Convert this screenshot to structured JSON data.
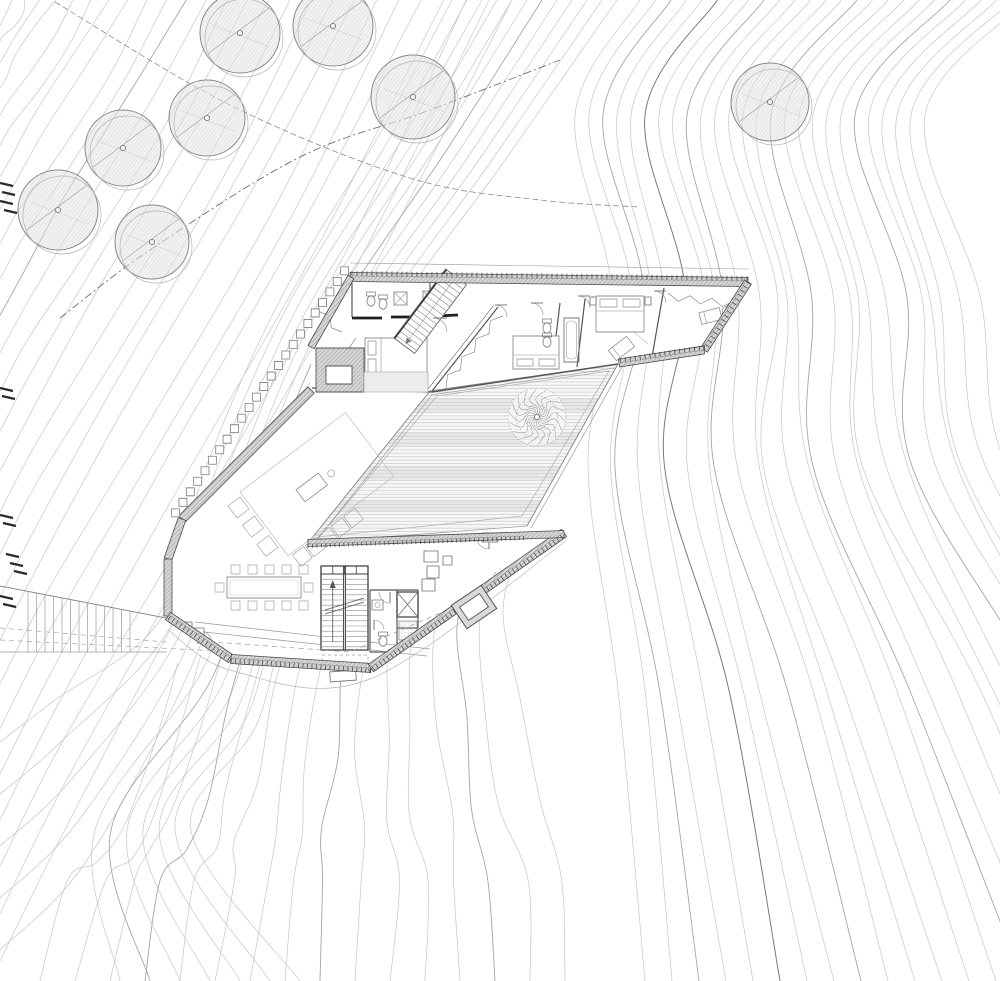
{
  "document": {
    "type": "architectural-site-plan",
    "canvas_width": 1000,
    "canvas_height": 981,
    "background": "#ffffff"
  },
  "palette": {
    "contour": "#c6c6c6",
    "contour_index": "#a6a6a6",
    "contour_dark": "#7a7a7a",
    "wall_edge": "#4a4a4a",
    "wall_fill": "#d6d6d6",
    "wall_hatch": "#9b9b9b",
    "furniture": "#8f8f8f",
    "thin_gray": "#9a9a9a",
    "deck_line": "#c2c2c2",
    "deck_band": "#e9e9e9",
    "tree_outline": "#898989",
    "tree_hatch": "#c2c2c2",
    "comb": "#3f3f3f",
    "cliff": "#2a2a2a",
    "drip": "#b8b8b8"
  },
  "contours": {
    "families": [
      {
        "name": "northwest-slope",
        "count": 26
      },
      {
        "name": "west-wrap",
        "count": 12
      },
      {
        "name": "east-slope",
        "count": 26
      },
      {
        "name": "south-fan",
        "count": 16
      }
    ],
    "boundary_lines": [
      {
        "pts": [
          [
            55,
            2
          ],
          [
            230,
            105
          ],
          [
            410,
            178
          ],
          [
            540,
            200
          ],
          [
            640,
            207
          ]
        ],
        "dash": "6,3",
        "color": "#8a8a8a",
        "w": 0.8
      },
      {
        "pts": [
          [
            60,
            318
          ],
          [
            150,
            250
          ],
          [
            300,
            157
          ],
          [
            430,
            110
          ],
          [
            560,
            60
          ]
        ],
        "dash": "8,3,2,3",
        "color": "#6f6f6f",
        "w": 0.9
      }
    ],
    "cliff_marks": [
      {
        "x": 0,
        "y": 183
      },
      {
        "x": 2,
        "y": 192
      },
      {
        "x": 0,
        "y": 201
      },
      {
        "x": 4,
        "y": 210
      },
      {
        "x": 0,
        "y": 388
      },
      {
        "x": 2,
        "y": 396
      },
      {
        "x": 0,
        "y": 515
      },
      {
        "x": 3,
        "y": 523
      },
      {
        "x": 6,
        "y": 554
      },
      {
        "x": 10,
        "y": 563
      },
      {
        "x": 14,
        "y": 571
      },
      {
        "x": 0,
        "y": 596
      },
      {
        "x": 3,
        "y": 604
      }
    ]
  },
  "site": {
    "trees": [
      {
        "x": 240,
        "y": 33,
        "r": 40
      },
      {
        "x": 333,
        "y": 26,
        "r": 40
      },
      {
        "x": 413,
        "y": 97,
        "r": 42
      },
      {
        "x": 207,
        "y": 118,
        "r": 38
      },
      {
        "x": 123,
        "y": 148,
        "r": 38
      },
      {
        "x": 58,
        "y": 210,
        "r": 40
      },
      {
        "x": 152,
        "y": 242,
        "r": 37
      },
      {
        "x": 770,
        "y": 102,
        "r": 39
      }
    ],
    "courtyard_tree": {
      "x": 537,
      "y": 417,
      "r": 29
    },
    "walkway": {
      "rail_top": [
        [
          0,
          586
        ],
        [
          166,
          618
        ]
      ],
      "rail_bottom": [
        [
          0,
          652
        ],
        [
          167,
          652
        ]
      ],
      "tread_from": 28,
      "tread_to": 130,
      "tread_count": 13,
      "dashes": [
        [
          [
            0,
            628
          ],
          [
            166,
            642
          ]
        ],
        [
          [
            0,
            640
          ],
          [
            240,
            652
          ]
        ]
      ]
    }
  },
  "building": {
    "envelope": [
      [
        352,
        276
      ],
      [
        747,
        281
      ],
      [
        703,
        350
      ],
      [
        618,
        363
      ],
      [
        527,
        525
      ],
      [
        563,
        533
      ],
      [
        370,
        668
      ],
      [
        230,
        659
      ],
      [
        168,
        615
      ],
      [
        168,
        558
      ],
      [
        183,
        518
      ],
      [
        310,
        391
      ],
      [
        312,
        345
      ]
    ],
    "deck": {
      "outline": [
        [
          430,
          391
        ],
        [
          618,
          364
        ],
        [
          527,
          526
        ],
        [
          308,
          543
        ]
      ],
      "inner_outline": [
        [
          437,
          396
        ],
        [
          609,
          371
        ],
        [
          522,
          516
        ],
        [
          319,
          537
        ]
      ],
      "light_bands": [
        [
          398,
          14
        ],
        [
          432,
          14
        ],
        [
          466,
          14
        ],
        [
          500,
          12
        ]
      ]
    },
    "wall_bands": [
      {
        "p1": [
          350,
          277
        ],
        "p2": [
          748,
          282
        ],
        "w": 9
      },
      {
        "p1": [
          748,
          282
        ],
        "p2": [
          704,
          350
        ],
        "w": 8
      },
      {
        "p1": [
          704,
          350
        ],
        "p2": [
          619,
          363
        ],
        "w": 8
      },
      {
        "p1": [
          351,
          277
        ],
        "p2": [
          311,
          347
        ],
        "w": 7
      },
      {
        "p1": [
          311,
          390
        ],
        "p2": [
          182,
          519
        ],
        "w": 9
      },
      {
        "p1": [
          182,
          519
        ],
        "p2": [
          168,
          559
        ],
        "w": 8
      },
      {
        "p1": [
          168,
          559
        ],
        "p2": [
          168,
          616
        ],
        "w": 8
      },
      {
        "p1": [
          168,
          616
        ],
        "p2": [
          231,
          659
        ],
        "w": 9
      },
      {
        "p1": [
          231,
          659
        ],
        "p2": [
          371,
          668
        ],
        "w": 9
      },
      {
        "p1": [
          371,
          668
        ],
        "p2": [
          564,
          533
        ],
        "w": 9
      },
      {
        "p1": [
          308,
          543
        ],
        "p2": [
          564,
          534
        ],
        "w": 7
      }
    ],
    "combs": [
      {
        "p1": [
          352,
          271
        ],
        "p2": [
          748,
          276
        ],
        "side": 1,
        "len": 5,
        "step": 5
      },
      {
        "p1": [
          750,
          284
        ],
        "p2": [
          707,
          351
        ],
        "side": 1,
        "len": 5,
        "step": 5
      },
      {
        "p1": [
          704,
          345
        ],
        "p2": [
          620,
          358
        ],
        "side": -1,
        "len": 5,
        "step": 5
      },
      {
        "p1": [
          371,
          673
        ],
        "p2": [
          564,
          538
        ],
        "side": -1,
        "len": 5,
        "step": 4.5
      },
      {
        "p1": [
          168,
          620
        ],
        "p2": [
          231,
          663
        ],
        "side": -1,
        "len": 5,
        "step": 4.5
      },
      {
        "p1": [
          231,
          663
        ],
        "p2": [
          371,
          673
        ],
        "side": -1,
        "len": 5,
        "step": 4.5
      },
      {
        "p1": [
          308,
          548
        ],
        "p2": [
          524,
          540
        ],
        "side": -1,
        "len": 4,
        "step": 4.5
      }
    ],
    "square_chain": {
      "from": [
        352,
        276
      ],
      "to": [
        183,
        518
      ],
      "count": 24,
      "size": 8,
      "offset": 9
    },
    "fireplace": {
      "block": [
        316,
        348,
        48,
        44
      ],
      "inner": [
        326,
        366,
        26,
        18
      ],
      "side": [
        364,
        372,
        64,
        20
      ]
    },
    "interior_walls": [
      [
        430,
        281,
        430,
        317,
        1.2
      ],
      [
        352,
        283,
        352,
        317,
        1.2
      ],
      [
        312,
        388,
        432,
        392,
        1.3
      ],
      [
        432,
        392,
        618,
        364,
        1.4
      ],
      [
        498,
        307,
        432,
        391,
        1.2
      ],
      [
        494,
        305,
        428,
        389,
        0.6
      ],
      [
        560,
        303,
        552,
        369,
        1.2
      ],
      [
        585,
        299,
        577,
        367,
        1.2
      ],
      [
        664,
        288,
        652,
        357,
        1.2
      ],
      [
        370,
        590,
        418,
        590,
        1.2
      ],
      [
        370,
        590,
        370,
        652,
        1.2
      ],
      [
        397,
        590,
        397,
        652,
        1.2
      ],
      [
        370,
        652,
        397,
        652,
        1.2
      ],
      [
        418,
        590,
        418,
        628,
        1.2
      ],
      [
        397,
        628,
        418,
        628,
        1.2
      ]
    ],
    "lintels": [
      [
        352,
        318,
        382,
        318
      ],
      [
        391,
        317,
        427,
        317
      ],
      [
        436,
        316,
        458,
        315
      ]
    ],
    "deck_edges": [
      [
        618,
        364,
        527,
        526,
        0.9
      ],
      [
        622,
        367,
        531,
        528,
        0.6
      ],
      [
        430,
        391,
        618,
        364,
        0.9
      ],
      [
        431,
        395,
        615,
        368,
        0.6
      ],
      [
        308,
        543,
        430,
        391,
        0.9
      ],
      [
        312,
        546,
        432,
        395,
        0.6
      ]
    ],
    "thin_lines": [
      [
        195,
        622,
        430,
        649,
        0.7
      ],
      [
        195,
        631,
        427,
        656,
        0.7
      ],
      [
        350,
        263,
        749,
        269,
        0.6
      ],
      [
        592,
        296,
        648,
        344,
        0.5
      ]
    ],
    "drip_lines": [
      {
        "pts": [
          [
            168,
            630
          ],
          [
            233,
            671
          ],
          [
            370,
            679
          ],
          [
            566,
            541
          ]
        ]
      }
    ],
    "stair_main": {
      "x": 321,
      "y": 566,
      "w": 47,
      "h": 84,
      "divider": 344.5,
      "step": 5.2,
      "header_h": 8
    },
    "stair_upper": {
      "x": 456,
      "y": 277,
      "angle": 127,
      "len": 86,
      "width": 26,
      "step": 5.5
    },
    "elevator": {
      "x": 397,
      "y": 592,
      "w": 21,
      "h": 25
    },
    "shower_tile": {
      "x": 399,
      "y": 621,
      "w": 18,
      "h": 19
    },
    "light_well": {
      "cx": 474,
      "cy": 607,
      "w": 36,
      "h": 28,
      "rot": -34,
      "band": 6
    },
    "furniture": [
      {
        "kind": "bed",
        "x": 365,
        "y": 338,
        "w": 62,
        "h": 38,
        "pillows": "left"
      },
      {
        "kind": "bed",
        "x": 513,
        "y": 336,
        "w": 46,
        "h": 33,
        "pillows": "bottom"
      },
      {
        "kind": "bed",
        "x": 596,
        "y": 296,
        "w": 48,
        "h": 36,
        "pillows": "top"
      },
      {
        "kind": "chair-lounge",
        "x": 610,
        "y": 342,
        "w": 23,
        "h": 13,
        "rot": -38
      },
      {
        "kind": "chair-lounge",
        "x": 700,
        "y": 310,
        "w": 21,
        "h": 12,
        "rot": -15
      }
    ],
    "dining": {
      "table": [
        227,
        577,
        74,
        21
      ],
      "chair": 9,
      "top_y": 565,
      "bottom_y": 601,
      "xs": [
        231,
        248,
        265,
        282,
        299
      ],
      "end_left": [
        215,
        583
      ],
      "end_right": [
        304,
        583
      ]
    },
    "sofa_group": {
      "tx": 240,
      "ty": 492,
      "rot": -37,
      "rug": [
        0,
        0,
        132,
        80
      ],
      "sofa_y": 82,
      "sofa_n": 5,
      "chair_x": -18,
      "chair_n": 3,
      "table": [
        46,
        32,
        28,
        15
      ]
    },
    "fixtures": [
      {
        "kind": "toilet",
        "x": 371,
        "y": 301
      },
      {
        "kind": "toilet",
        "x": 383,
        "y": 304
      },
      {
        "kind": "shower-x",
        "x": 394,
        "y": 292,
        "w": 13,
        "h": 13
      },
      {
        "kind": "shower-x",
        "x": 423,
        "y": 291,
        "w": 13,
        "h": 13
      },
      {
        "kind": "toilet",
        "x": 547,
        "y": 328
      },
      {
        "kind": "toilet",
        "x": 547,
        "y": 342
      },
      {
        "kind": "tub",
        "x": 564,
        "y": 318,
        "w": 15,
        "h": 44
      },
      {
        "kind": "sink",
        "x": 372,
        "y": 600,
        "w": 11,
        "h": 10
      },
      {
        "kind": "toilet",
        "x": 383,
        "y": 641
      }
    ],
    "zigzags": [
      {
        "x1": 356,
        "y1": 338,
        "x2": 356,
        "y2": 378,
        "amp": 7
      },
      {
        "x1": 503,
        "y1": 316,
        "x2": 446,
        "y2": 388,
        "amp": 7
      },
      {
        "x1": 668,
        "y1": 293,
        "x2": 734,
        "y2": 301,
        "amp": 7
      },
      {
        "x1": 734,
        "y1": 301,
        "x2": 712,
        "y2": 345,
        "amp": 7
      },
      {
        "x1": 318,
        "y1": 300,
        "x2": 342,
        "y2": 332,
        "amp": 6
      }
    ],
    "doors": [
      {
        "cx": 447,
        "cy": 318,
        "r": 14,
        "a0": 180,
        "a1": 90
      },
      {
        "cx": 507,
        "cy": 305,
        "r": 12,
        "a0": 180,
        "a1": 90
      },
      {
        "cx": 543,
        "cy": 303,
        "r": 12,
        "a0": 180,
        "a1": 90
      },
      {
        "cx": 590,
        "cy": 296,
        "r": 12,
        "a0": 180,
        "a1": 90
      },
      {
        "cx": 666,
        "cy": 291,
        "r": 12,
        "a0": 180,
        "a1": 90
      },
      {
        "cx": 390,
        "cy": 592,
        "r": 11,
        "a0": 90,
        "a1": 180
      },
      {
        "cx": 374,
        "cy": 630,
        "r": 10,
        "a0": 270,
        "a1": 0
      },
      {
        "cx": 489,
        "cy": 536,
        "r": 13,
        "a0": 90,
        "a1": 180
      },
      {
        "cx": 198,
        "cy": 644,
        "r": 14,
        "a0": 270,
        "a1": 0
      }
    ],
    "dashed_paths": [
      {
        "pts": [
          [
            200,
            641
          ],
          [
            350,
            652
          ],
          [
            470,
            600
          ],
          [
            500,
            568
          ]
        ],
        "dash": "5,4"
      },
      {
        "pts": [
          [
            322,
            655
          ],
          [
            368,
            655
          ],
          [
            368,
            663
          ],
          [
            322,
            663
          ],
          [
            322,
            655
          ]
        ],
        "dash": "3,3"
      }
    ],
    "misc_rects": [
      [
        482,
        533,
        16,
        9,
        0
      ],
      [
        330,
        671,
        26,
        10,
        -4
      ],
      [
        424,
        551,
        14,
        11,
        0
      ],
      [
        427,
        566,
        12,
        12,
        0
      ],
      [
        422,
        579,
        13,
        12,
        0
      ],
      [
        443,
        556,
        9,
        9,
        0
      ],
      [
        182,
        622,
        10,
        9,
        0
      ],
      [
        194,
        628,
        10,
        9,
        0
      ],
      [
        590,
        297,
        6,
        8,
        0
      ],
      [
        645,
        297,
        6,
        8,
        0
      ]
    ]
  }
}
